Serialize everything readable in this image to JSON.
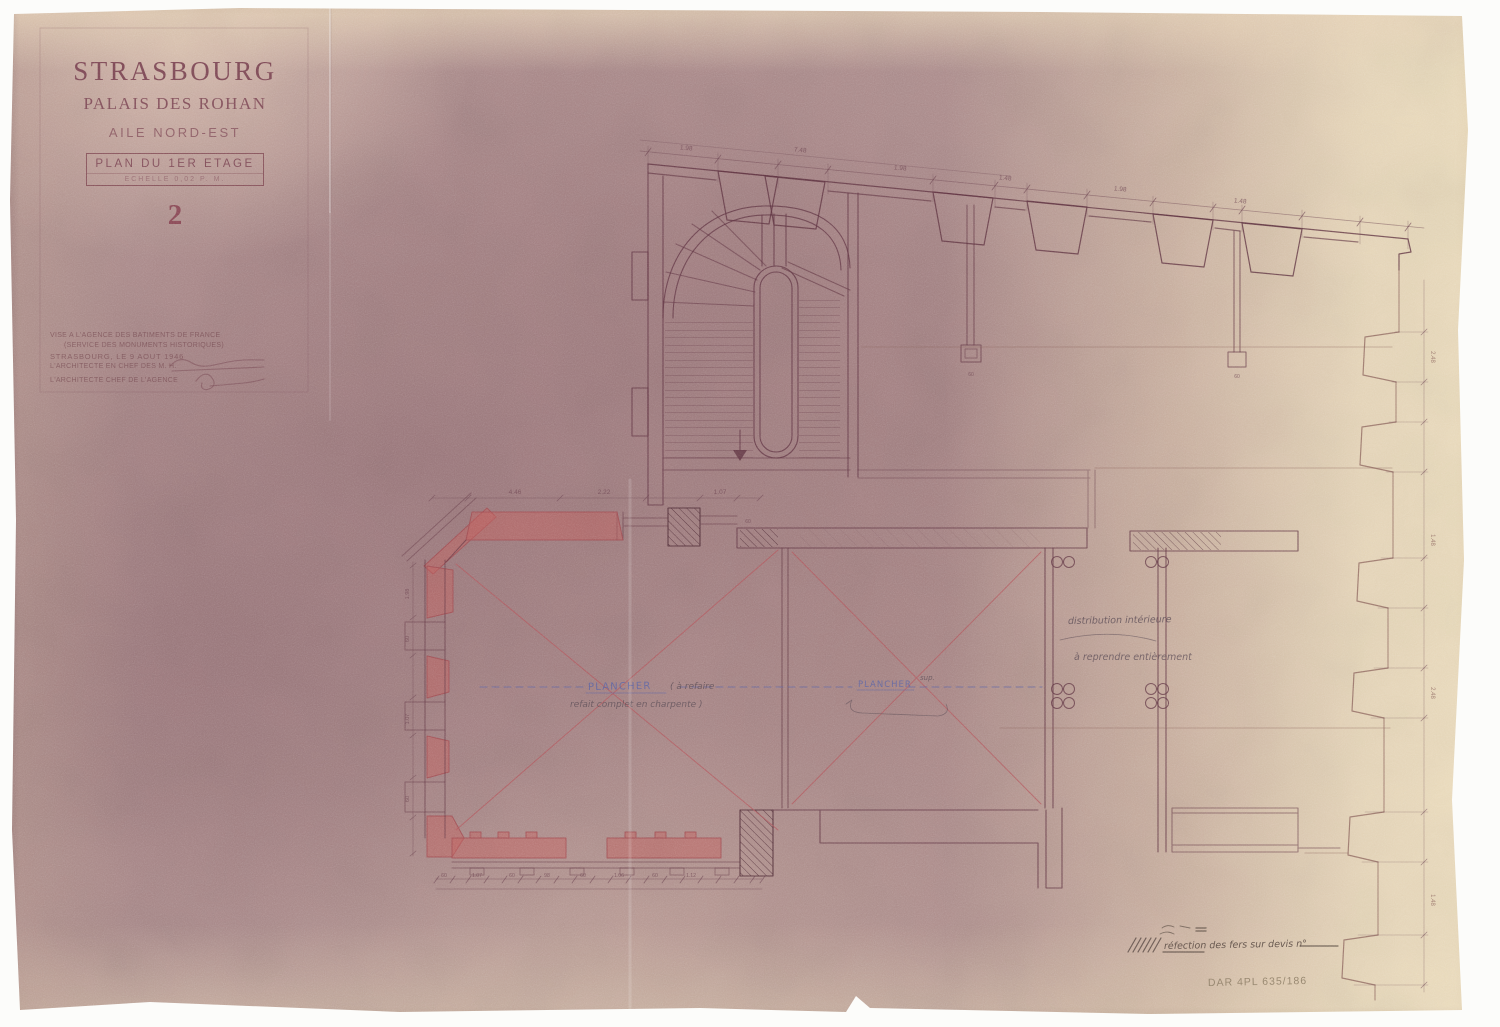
{
  "sheet": {
    "title": "STRASBOURG",
    "subtitle": "PALAIS DES ROHAN",
    "wing": "AILE NORD-EST",
    "plan_label": "PLAN DU 1ER ETAGE",
    "scale_label": "ECHELLE 0,02 P. M.",
    "sheet_number": "2"
  },
  "stamp": {
    "line1": "VISE A L'AGENCE DES BATIMENTS DE FRANCE",
    "line2": "(SERVICE DES MONUMENTS HISTORIQUES)",
    "line3": "STRASBOURG, LE 9 AOUT 1946",
    "line4": "L'ARCHITECTE EN CHEF DES M. H.",
    "line5": "L'ARCHITECTE CHEF DE L'AGENCE"
  },
  "annotations": {
    "plancher_left_title": "PLANCHER",
    "plancher_left_note1": "( à refaire",
    "plancher_left_note2": "refait complet en charpente )",
    "plancher_right_title": "PLANCHER",
    "plancher_right_note": "sup.",
    "room_note_line1": "distribution intérieure",
    "room_note_line2": "à reprendre entièrement",
    "legend_note": "réfection des fers sur devis n°",
    "archive_ref": "DAR 4PL 635/186"
  },
  "dimensions": {
    "top": [
      "1.98",
      "7.48",
      "1.98",
      "1.48",
      "1.98",
      "1.48"
    ],
    "mid": [
      "4.46",
      "2.22",
      "1.07",
      "60"
    ],
    "bottom": [
      "60",
      "1.07",
      "60",
      "98",
      "60",
      "1.06",
      "60",
      "1.12"
    ],
    "left": [
      "1.98",
      "60",
      "1.07",
      "60"
    ],
    "right": [
      "2.48",
      "1.48",
      "2.48",
      "1.48"
    ],
    "flue": [
      "60",
      "60"
    ]
  },
  "colors": {
    "ink": "#5f3240",
    "red_wash": "#c4605e",
    "blue_note": "#5c63a4",
    "pencil": "#7c6a58",
    "paper_mauve": "#b09190",
    "paper_tan": "#ecddbd"
  }
}
